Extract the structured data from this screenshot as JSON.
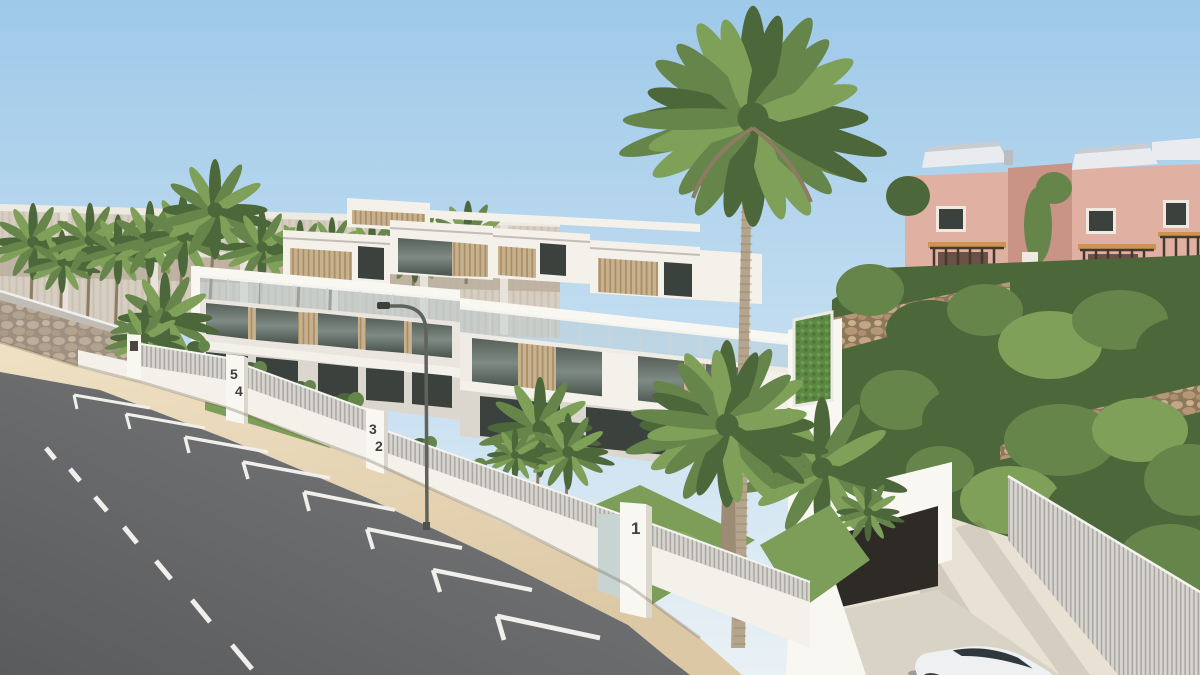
{
  "scene": {
    "type": "architectural-render",
    "description": "Sunlit 3D architectural rendering of a modern white townhouse development along a sloping street with palm trees, parking-bay road markings, stone retaining walls, lush hillside greenery, pink neighbouring houses and an underground garage ramp with a white car."
  },
  "gate_pillars": [
    {
      "numbers": [
        "5",
        "4"
      ]
    },
    {
      "numbers": [
        "3",
        "2"
      ]
    },
    {
      "numbers": [
        "1"
      ]
    }
  ],
  "palette": {
    "sky_top": "#9ec9e9",
    "sky_mid": "#c6dff1",
    "sky_horizon": "#eaf1f5",
    "building_white": "#f4f1ea",
    "building_bright": "#f9f7f2",
    "building_shadow": "#dcd7ce",
    "glass_dark": "#3b423e",
    "wood_slat": "#c8b18d",
    "fence_gray": "#d8d5cf",
    "stone_tan": "#9d9080",
    "stone_pink": "#8f7a5e",
    "pink_facade": "#e0b0a2",
    "pink_shadow": "#c99385",
    "pink_arch": "#aa7568",
    "roof_white": "#e9ebee",
    "beam_orange": "#cf9351",
    "railing_dark": "#42392f",
    "green_dark": "#4c683a",
    "green_mid": "#66854a",
    "green_light": "#7fa058",
    "grass": "#7c9e58",
    "trunk": "#8d7c64",
    "road": "#7b7c7e",
    "road_dark": "#5a5b5d",
    "sidewalk": "#ead9ba",
    "marking_white": "#f0efec",
    "lamp_metal": "#5f635b",
    "car_white": "#eef0f1",
    "number_dark": "#3f3f3f"
  }
}
